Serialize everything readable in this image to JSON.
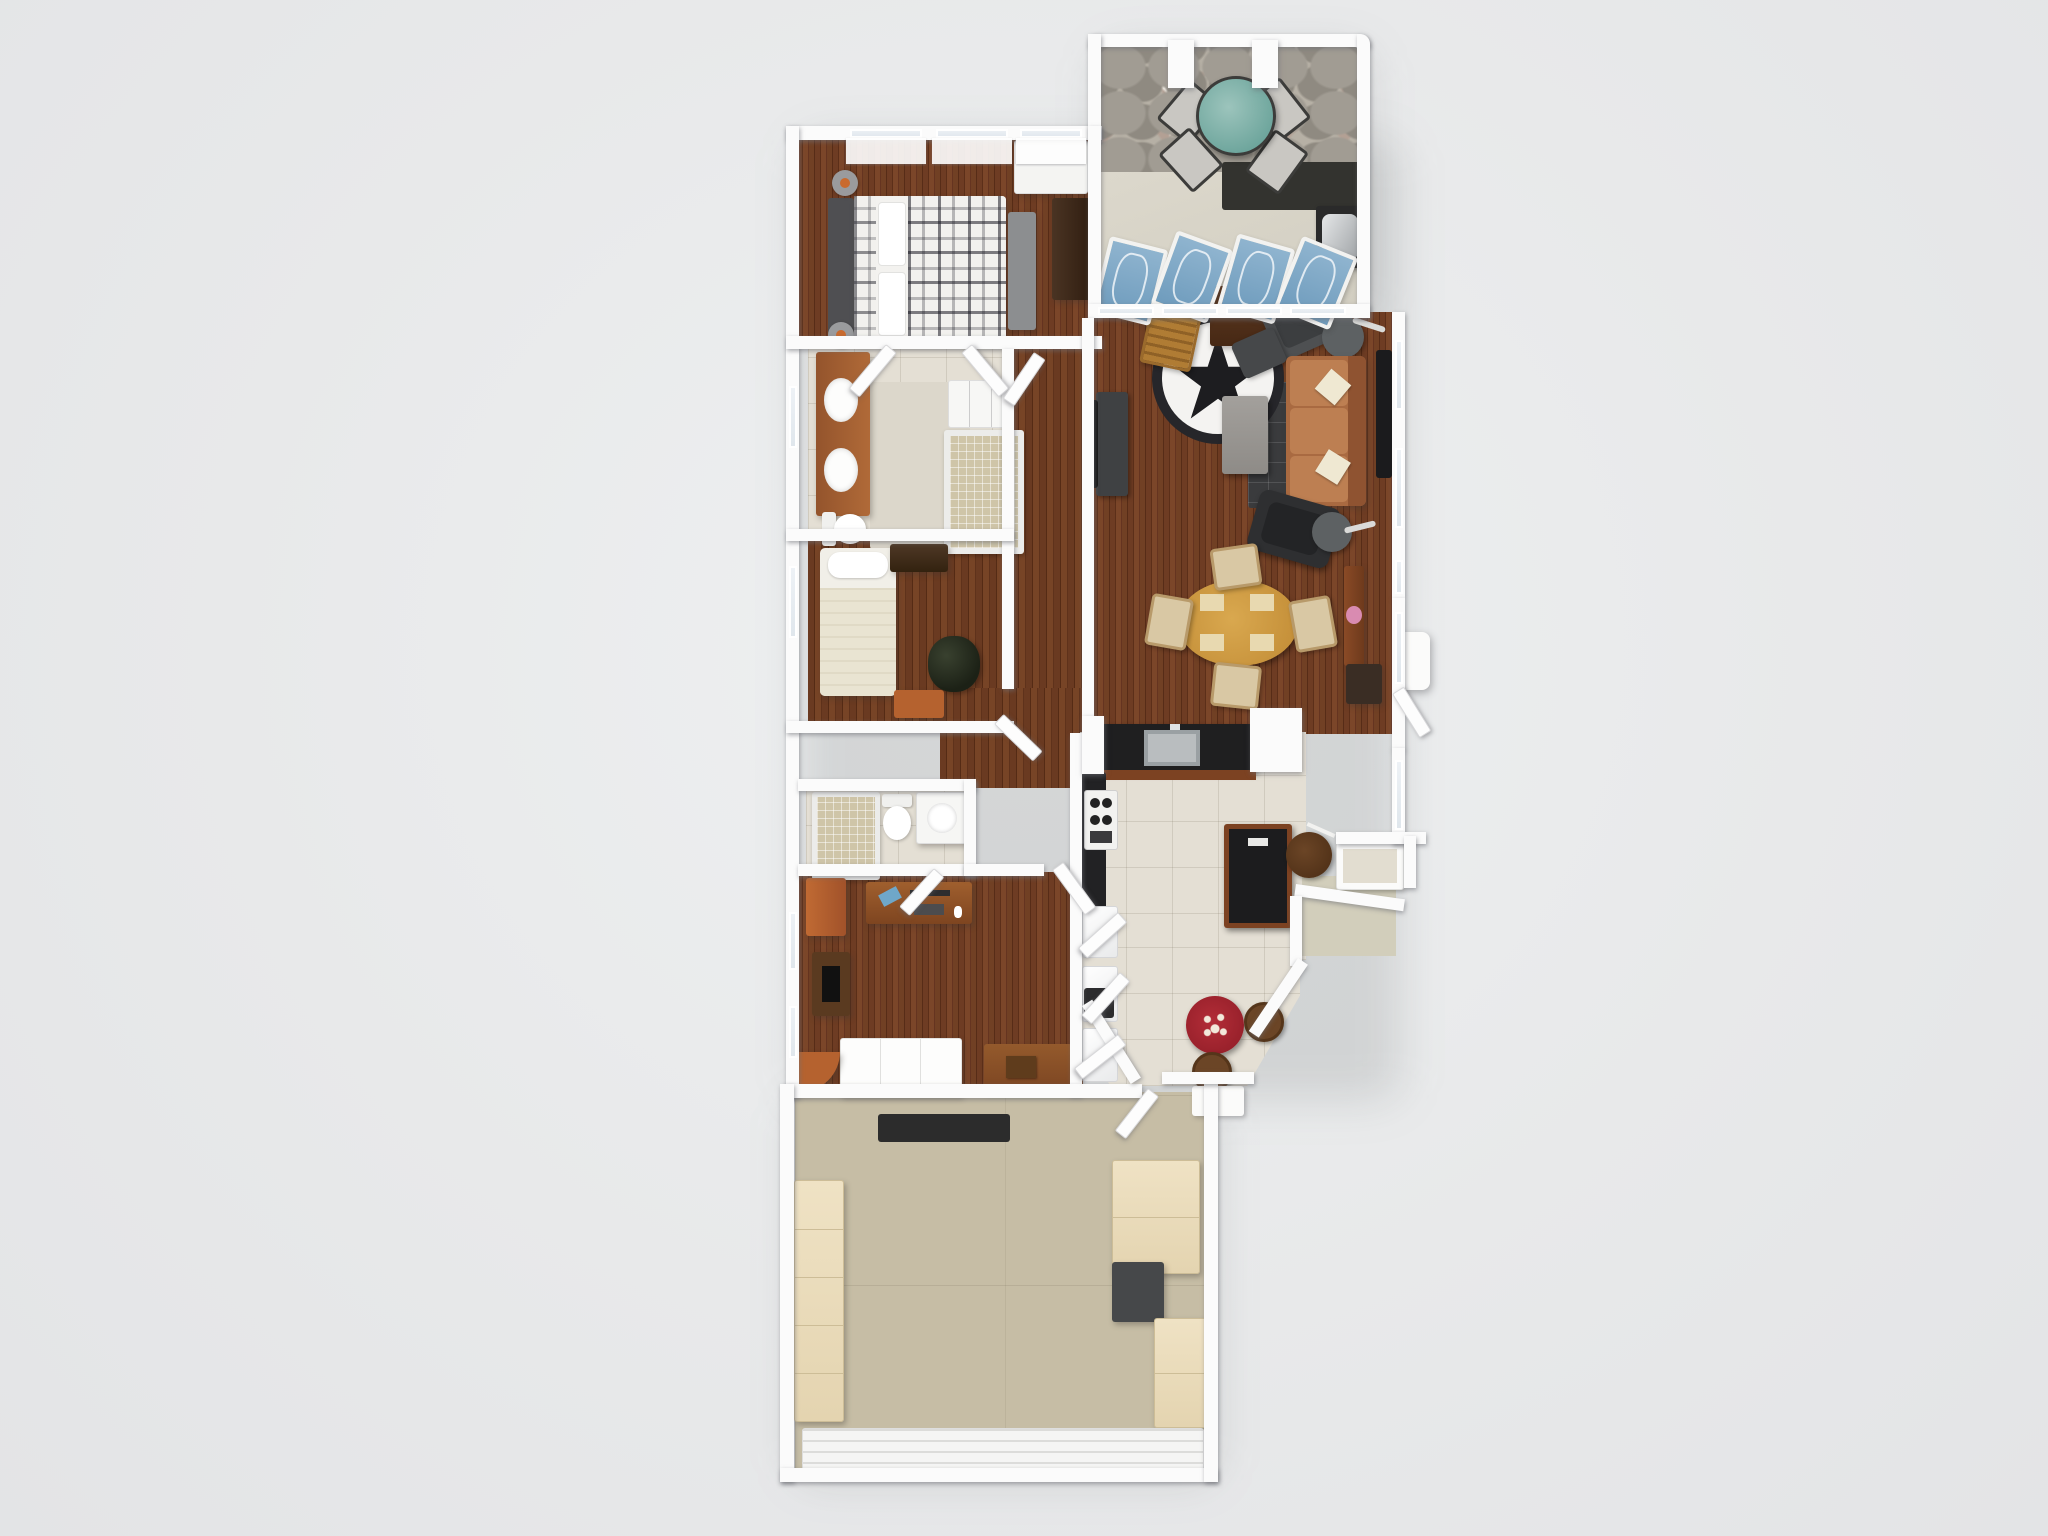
{
  "scene": {
    "title": "3D Floor Plan Rendering",
    "view": "top-down bird's-eye 3D dollhouse render",
    "background_color": "#e8e9ea",
    "visible_text": []
  },
  "palette": {
    "wall_white": "#fbfbfb",
    "hardwood_brown": "#68391f",
    "tile_beige": "#e4dfd4",
    "garage_concrete_tan": "#c6bda5",
    "deck_concrete": "#d8d4c8",
    "patio_flagstone_gray": "#a19c93",
    "sofa_terracotta": "#b5734a",
    "recliner_black": "#2e2f31",
    "dining_table_oak": "#cf9a44",
    "nook_table_red": "#a3242e",
    "accent_cabinet_orange": "#b5622f",
    "counter_black": "#1f1f20",
    "cabinet_wood": "#7c4222",
    "lounger_blue": "#7fa9c9",
    "glass_table_teal": "#7fb2aa",
    "rug_star_black": "#1d1d20",
    "cream_cabinet": "#ecdfc2"
  },
  "rooms": [
    {
      "id": "stone-patio",
      "label": "Stone patio",
      "furniture": [
        "round-glass-table",
        "patio-sling-chair x4",
        "stone-knee-wall",
        "patio-pillars"
      ]
    },
    {
      "id": "sun-deck",
      "label": "Sun deck / sunroom",
      "furniture": [
        "chaise-lounger x4",
        "bbq-grill",
        "dark-counter-bar",
        "window-wall"
      ]
    },
    {
      "id": "master-bedroom",
      "label": "Master bedroom",
      "furniture": [
        "plaid-double-bed",
        "headboard",
        "nightstand x2",
        "foot-bench",
        "wardrobe",
        "closet-shelf",
        "triple-window"
      ]
    },
    {
      "id": "master-bathroom",
      "label": "Master bathroom",
      "furniture": [
        "double-sink-vanity",
        "toilet",
        "walk-in-shower",
        "closet-shelves",
        "area-rug",
        "double-doors"
      ]
    },
    {
      "id": "bedroom-2",
      "label": "Bedroom 2",
      "furniture": [
        "single-bed",
        "dresser",
        "potted-plant",
        "nightstand-orange"
      ]
    },
    {
      "id": "hallway",
      "label": "Hallway",
      "furniture": []
    },
    {
      "id": "bathroom-2",
      "label": "Bathroom 2",
      "furniture": [
        "shower",
        "toilet",
        "sink-vanity"
      ]
    },
    {
      "id": "office-den",
      "label": "Office / den",
      "furniture": [
        "computer-desk",
        "file-cabinet-orange",
        "media-stand-with-tv",
        "white-futon",
        "wood-table-with-box",
        "corner-shelf-orange"
      ]
    },
    {
      "id": "living-room",
      "label": "Living room",
      "furniture": [
        "star-rug",
        "rocking-chair",
        "plant-side-table",
        "gray-armchair",
        "ottoman",
        "round-side-table x2",
        "floor-lamp x2",
        "terracotta-sofa",
        "coffee-table",
        "dark-area-rug",
        "tv-console",
        "wall-tv-art",
        "black-recliner"
      ]
    },
    {
      "id": "dining-area",
      "label": "Dining area",
      "furniture": [
        "oval-dining-table",
        "dining-chair x4",
        "console-table-with-flowers",
        "waste-bin",
        "entry-landing"
      ]
    },
    {
      "id": "kitchen",
      "label": "Kitchen",
      "furniture": [
        "sink-peninsula-counter",
        "range-stove",
        "side-counter",
        "island-with-black-top",
        "round-stool",
        "window-bench",
        "pantry-closets",
        "open-doors"
      ]
    },
    {
      "id": "breakfast-nook",
      "label": "Breakfast nook (bay window)",
      "furniture": [
        "red-round-table",
        "wood-chair x2"
      ]
    },
    {
      "id": "entry-porch",
      "label": "Entry porch",
      "furniture": [
        "porch-mat",
        "landing-step"
      ]
    },
    {
      "id": "garage",
      "label": "Garage",
      "furniture": [
        "workbench-black",
        "storage-cabinets-left",
        "storage-cabinets-right",
        "utility-unit-dark",
        "garage-door"
      ]
    }
  ]
}
